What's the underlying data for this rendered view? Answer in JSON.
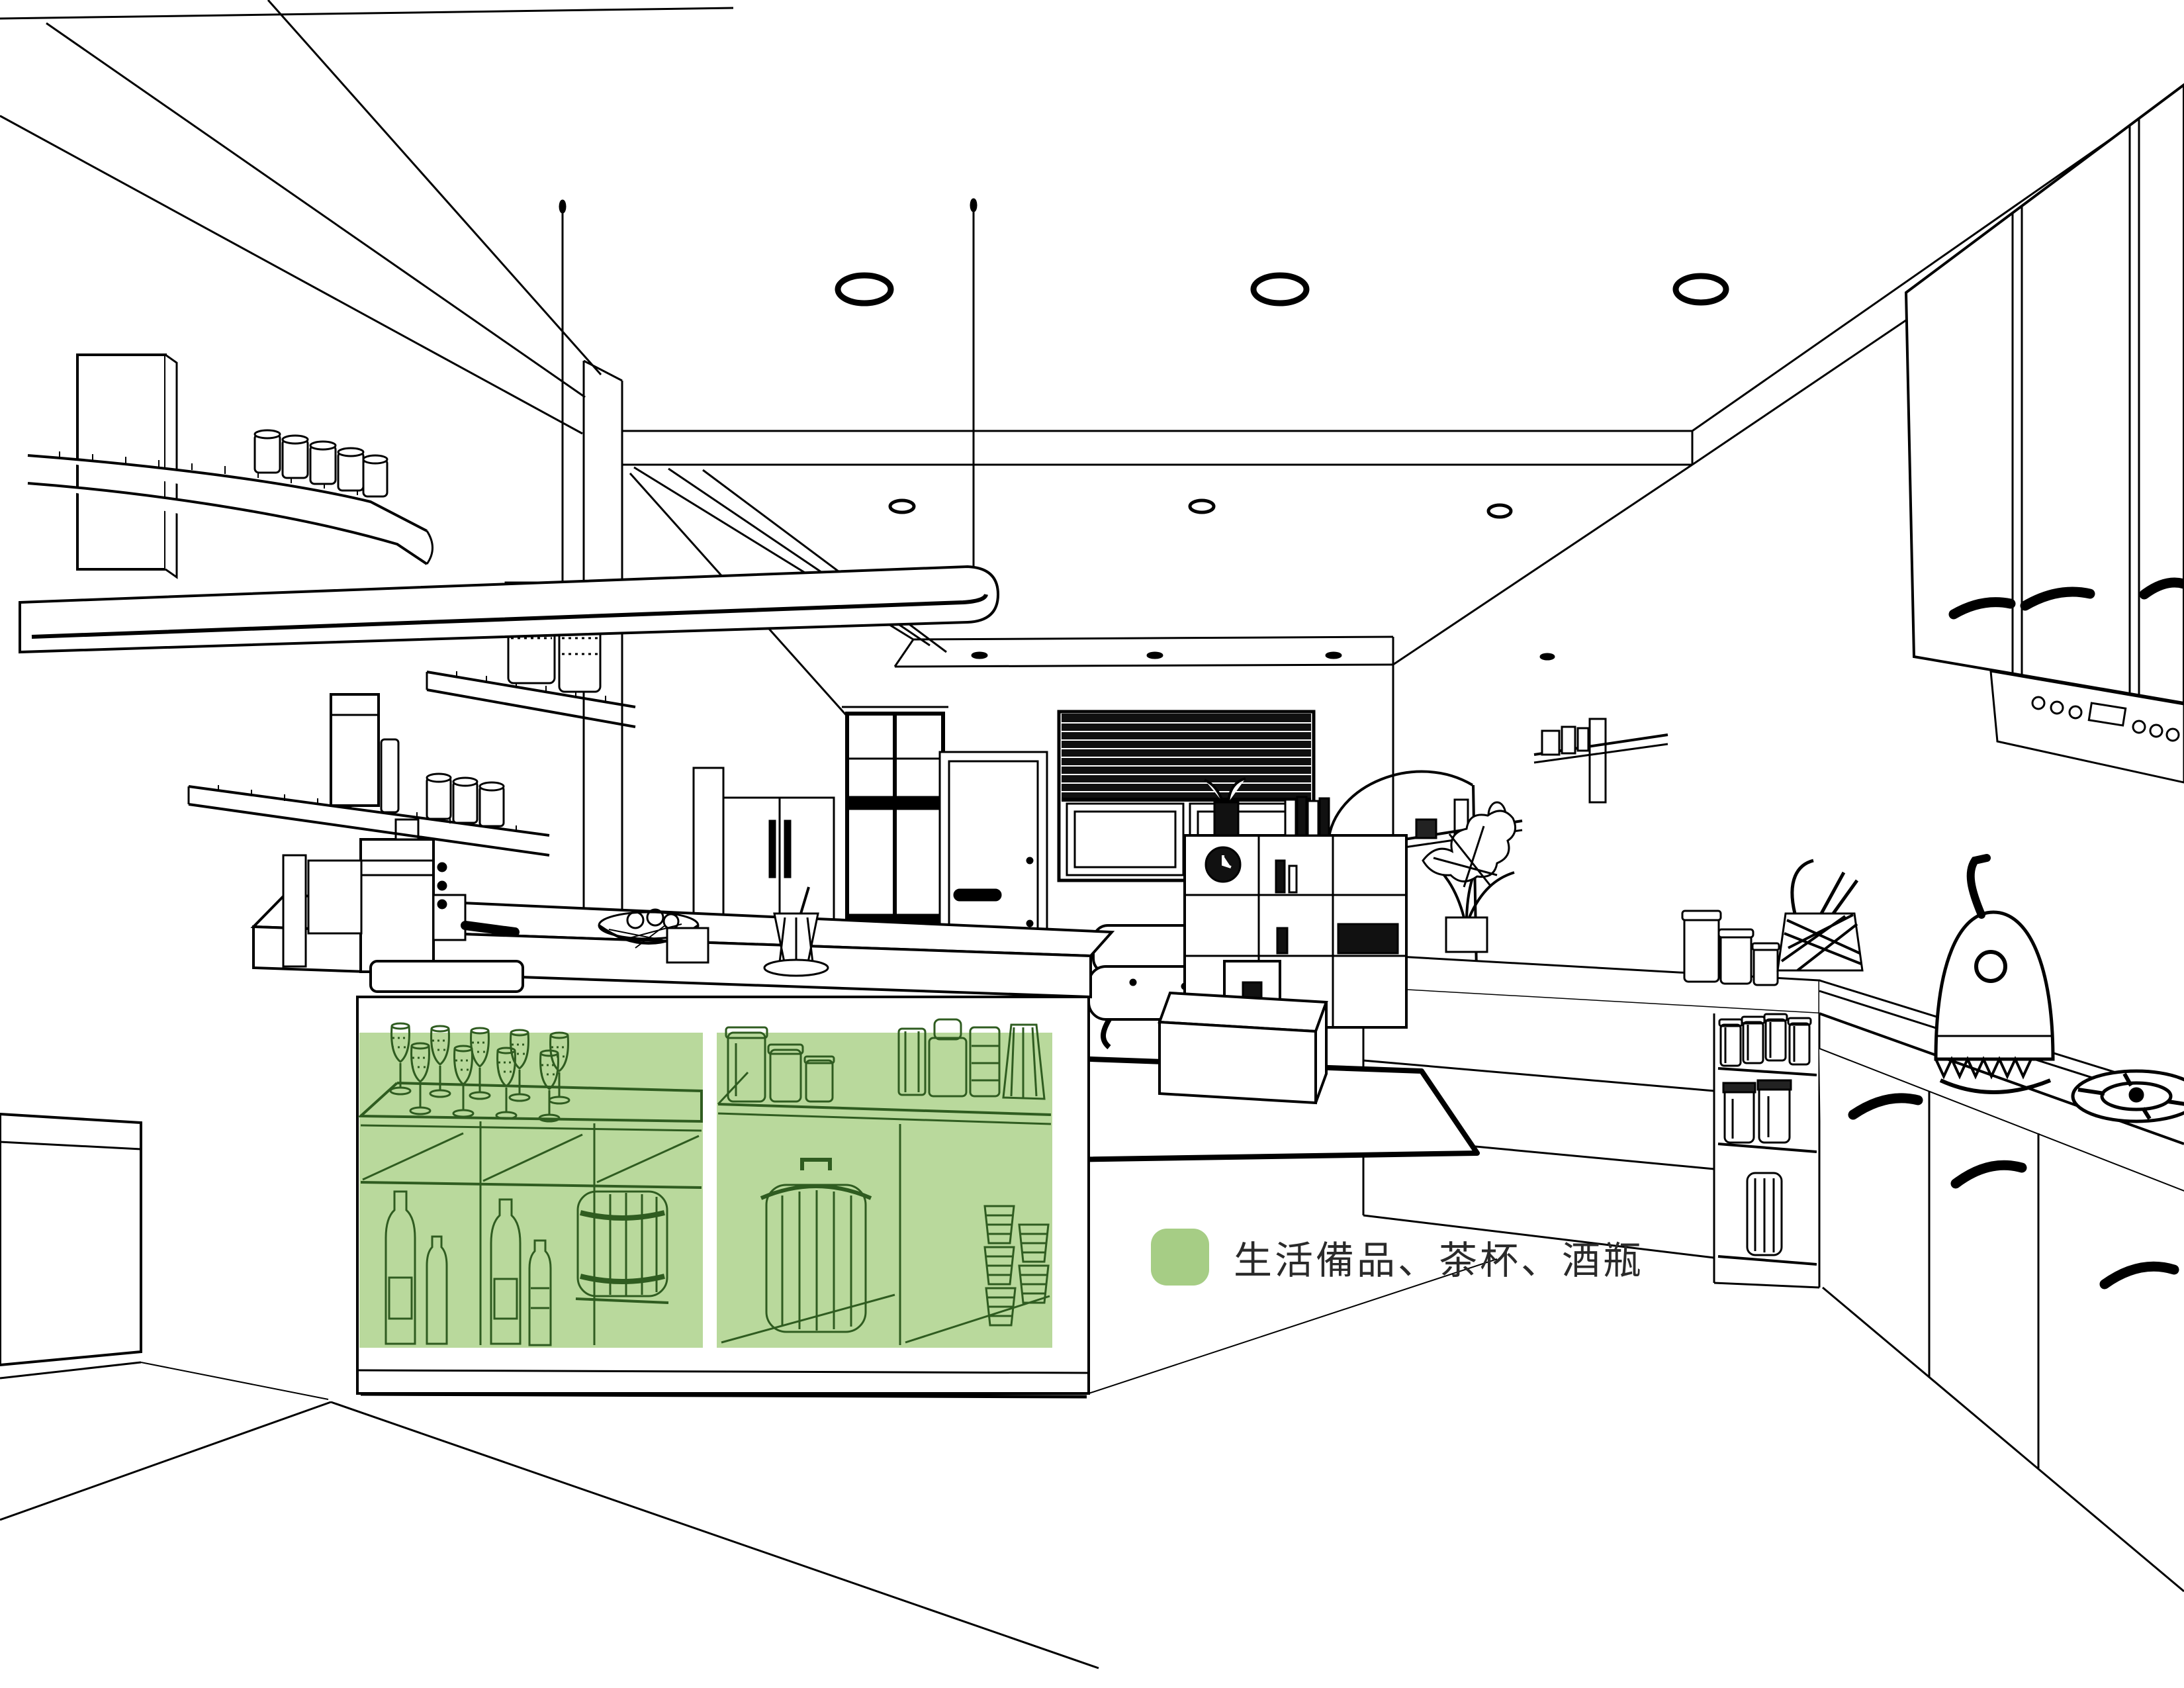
{
  "legend": {
    "label": "生活備品、茶杯、酒瓶",
    "swatch_color": "#a6cd85",
    "text_color": "#2a2a2a"
  },
  "highlight": {
    "fill": "#b9d99c",
    "line_color": "#2f5c20",
    "areas": [
      {
        "name": "island-left-open-shelf",
        "contents": [
          "champagne-glasses",
          "wine-bottles",
          "small-bottles",
          "barrel"
        ]
      },
      {
        "name": "island-right-open-shelf",
        "contents": [
          "mason-jars",
          "canisters",
          "lidded-bin",
          "stacked-cups"
        ]
      }
    ]
  },
  "drawing": {
    "ink": "#000000",
    "background": "#ffffff",
    "scene": "kitchen-interior-perspective-line-drawing",
    "elements": [
      "ceiling-beams",
      "recessed-ceiling-lights",
      "linear-pendant-light",
      "left-wall-shelves",
      "espresso-machine",
      "island-counter",
      "glass-partition",
      "entry-door",
      "window-venetian-blind",
      "refrigerator",
      "sofa",
      "coffee-table",
      "rug",
      "divider-shelf-unit",
      "arc-floor-lamp",
      "right-wall-shelves",
      "upper-cabinets",
      "hood-appliance",
      "back-counter-drawers",
      "pantry-open-shelf",
      "base-cabinets",
      "dome-kettle",
      "gas-burner",
      "wire-basket",
      "counter-canisters",
      "potted-plant"
    ]
  }
}
